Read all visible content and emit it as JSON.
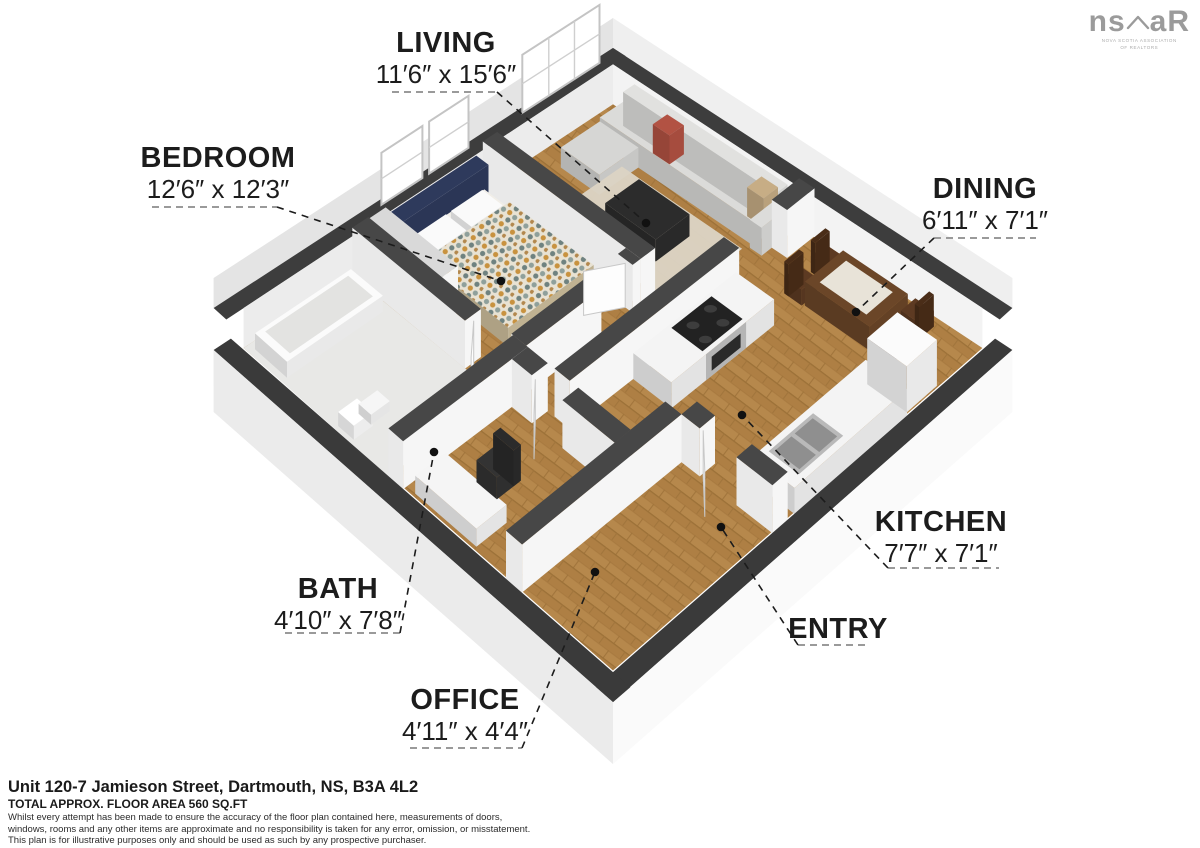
{
  "logo": {
    "left": "ns",
    "right": "aR",
    "tagline1": "NOVA SCOTIA ASSOCIATION",
    "tagline2": "OF REALTORS"
  },
  "rooms": [
    {
      "name": "LIVING",
      "dims": "11′6″ x 15′6″"
    },
    {
      "name": "BEDROOM",
      "dims": "12′6″ x 12′3″"
    },
    {
      "name": "DINING",
      "dims": "6′11″ x 7′1″"
    },
    {
      "name": "KITCHEN",
      "dims": "7′7″ x 7′1″"
    },
    {
      "name": "BATH",
      "dims": "4′10″ x 7′8″"
    },
    {
      "name": "OFFICE",
      "dims": "4′11″ x 4′4″"
    },
    {
      "name": "ENTRY",
      "dims": ""
    }
  ],
  "footer": {
    "address": "Unit 120-7 Jamieson Street, Dartmouth, NS, B3A 4L2",
    "area": "TOTAL APPROX. FLOOR AREA 560 SQ.FT",
    "disclaimer1": "Whilst every attempt has been made to ensure the accuracy of the floor plan contained here, measurements of doors,",
    "disclaimer2": "windows, rooms and any other items are approximate and no responsibility is taken for any error, omission, or misstatement.",
    "disclaimer3": "This plan is for illustrative purposes only and should be used as such by any prospective purchaser."
  },
  "colors": {
    "wall_cap": "#3d3d3d",
    "wood_floor": "#b6884c",
    "tile_floor": "#e8e8e6",
    "sofa": "#dbdbd9",
    "accent_pillow": "#b25243",
    "headboard": "#2e3a5c",
    "table_wood": "#6b4628",
    "label_text": "#1c1c1c",
    "logo_gray": "#9b9b9b"
  }
}
